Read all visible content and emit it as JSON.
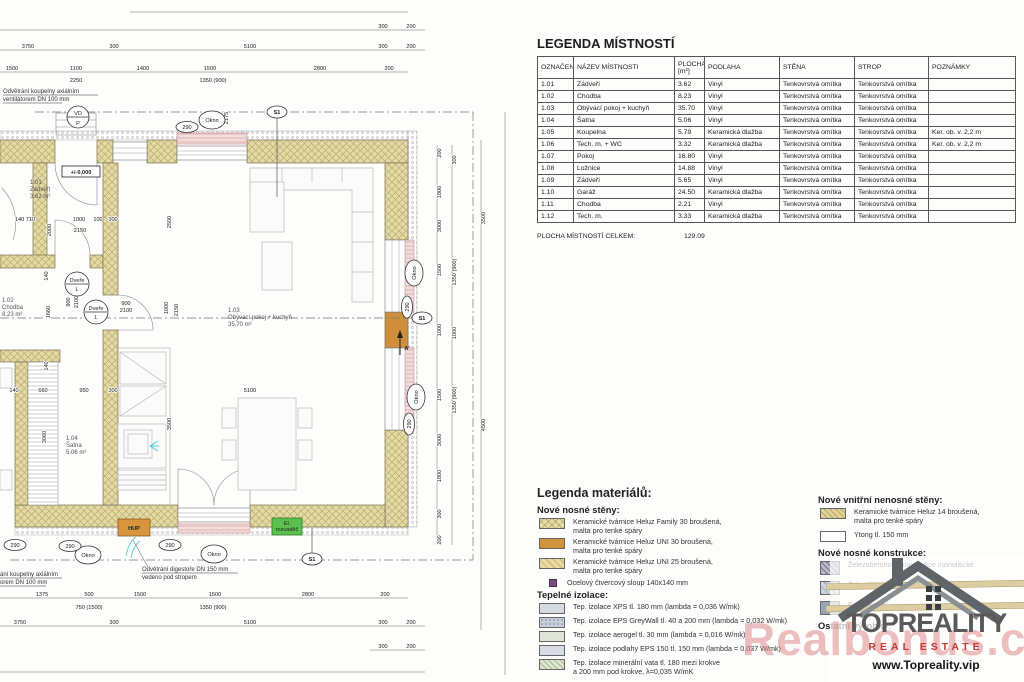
{
  "legend_table": {
    "title": "LEGENDA MÍSTNOSTÍ",
    "columns": [
      "OZNAČENÍ",
      "NÁZEV MÍSTNOSTI",
      "PLOCHA\n[m²]",
      "PODLAHA",
      "STĚNA",
      "STROP",
      "POZNÁMKY"
    ],
    "rows": [
      [
        "1.01",
        "Zádveří",
        "3.62",
        "Vinyl",
        "Tenkovrstvá omítka",
        "Tenkovrstvá omítka",
        ""
      ],
      [
        "1.02",
        "Chodba",
        "8.23",
        "Vinyl",
        "Tenkovrstvá omítka",
        "Tenkovrstvá omítka",
        ""
      ],
      [
        "1.03",
        "Obývací pokoj + kuchyň",
        "35.70",
        "Vinyl",
        "Tenkovrstvá omítka",
        "Tenkovrstvá omítka",
        ""
      ],
      [
        "1.04",
        "Šatna",
        "5.06",
        "Vinyl",
        "Tenkovrstvá omítka",
        "Tenkovrstvá omítka",
        ""
      ],
      [
        "1.05",
        "Koupelna",
        "5.79",
        "Keramická dlažba",
        "Tenkovrstvá omítka",
        "Tenkovrstvá omítka",
        "Ker. ob. v. 2,2 m"
      ],
      [
        "1.06",
        "Tech. m. + WC",
        "3.32",
        "Keramická dlažba",
        "Tenkovrstvá omítka",
        "Tenkovrstvá omítka",
        "Ker. ob. v. 2,2 m"
      ],
      [
        "1.07",
        "Pokoj",
        "16.80",
        "Vinyl",
        "Tenkovrstvá omítka",
        "Tenkovrstvá omítka",
        ""
      ],
      [
        "1.08",
        "Ložnice",
        "14.88",
        "Vinyl",
        "Tenkovrstvá omítka",
        "Tenkovrstvá omítka",
        ""
      ],
      [
        "1.09",
        "Zádveří",
        "5.65",
        "Vinyl",
        "Tenkovrstvá omítka",
        "Tenkovrstvá omítka",
        ""
      ],
      [
        "1.10",
        "Garáž",
        "24.50",
        "Keramická dlažba",
        "Tenkovrstvá omítka",
        "Tenkovrstvá omítka",
        ""
      ],
      [
        "1.11",
        "Chodba",
        "2.21",
        "Vinyl",
        "Tenkovrstvá omítka",
        "Tenkovrstvá omítka",
        ""
      ],
      [
        "1.12",
        "Tech. m.",
        "3.33",
        "Keramická dlažba",
        "Tenkovrstvá omítka",
        "Tenkovrstvá omítka",
        ""
      ]
    ],
    "total_label": "PLOCHA MÍSTNOSTÍ CELKEM:",
    "total_value": "129.09"
  },
  "materials": {
    "title": "Legenda materiálů:",
    "sections": [
      {
        "heading": "Nové nosné stěny:",
        "items": [
          {
            "swatch": "sw-family",
            "lines": [
              "Keramické tvárnice Heluz Family 30 broušená,",
              "malta pro tenké spáry"
            ]
          },
          {
            "swatch": "sw-uni30",
            "lines": [
              "Keramické tvárnice Heluz UNI 30 broušená,",
              "malta pro tenké spáry"
            ]
          },
          {
            "swatch": "sw-uni25",
            "lines": [
              "Keramické tvárnice Heluz UNI 25 broušená,",
              "malta pro tenké spáry"
            ]
          },
          {
            "swatch": "sw-steel",
            "lines": [
              "Ocelový čtvercový sloup 140x140 mm"
            ]
          }
        ]
      },
      {
        "heading": "Tepelné izolace:",
        "items": [
          {
            "swatch": "sw-xps",
            "lines": [
              "Tep. izolace XPS tl. 180 mm (lambda = 0,036 W/mk)"
            ]
          },
          {
            "swatch": "sw-eps",
            "lines": [
              "Tep. izolace EPS GreyWall tl. 40 a 200 mm (lambda = 0,032 W/mk)"
            ]
          },
          {
            "swatch": "sw-aerogel",
            "lines": [
              "Tep. izolace aerogel tl. 30 mm (lambda = 0,016 W/mk)"
            ]
          },
          {
            "swatch": "sw-floor",
            "lines": [
              "Tep. izolace podlahy EPS 150 tl. 150 mm (lambda = 0,037 W/mk)"
            ]
          },
          {
            "swatch": "sw-mineral",
            "lines": [
              "Tep. izolace minerální vata tl. 180 mezi krokve",
              "a 200 mm pod krokve, λ=0,035 W/mK"
            ]
          }
        ]
      },
      {
        "heading": "Nové vnitřní nenosné stěny:",
        "items": [
          {
            "swatch": "sw-heluz14",
            "lines": [
              "Keramické tvárnice Heluz 14 broušená,",
              "malta pro tenké spáry"
            ]
          },
          {
            "swatch": "sw-ytong",
            "lines": [
              "Ytong tl. 150 mm"
            ]
          }
        ]
      },
      {
        "heading": "Nové nosné konstrukce:",
        "items": [
          {
            "swatch": "sw-zbmono",
            "lines": [
              "Železobetonové konstrukce monolitické"
            ]
          },
          {
            "swatch": "sw-zbprefa",
            "lines": [
              "Železobetonové konstrukce prefa-monolitické"
            ]
          },
          {
            "swatch": "sw-beton",
            "lines": [
              "Beton prostý"
            ]
          }
        ]
      },
      {
        "heading": "Ostatní výrobky:",
        "items": []
      }
    ]
  },
  "plan": {
    "rooms": [
      {
        "id": "1.01",
        "name": "Zádveří",
        "area": "3.62 m²"
      },
      {
        "id": "1.02",
        "name": "Chodba",
        "area": "8.23 m²"
      },
      {
        "id": "1.03",
        "name": "Obývací pokoj + kuchyň",
        "area": "35.70 m²"
      },
      {
        "id": "1.04",
        "name": "Šatna",
        "area": "5.06 m²"
      }
    ],
    "elevation": "+/-0,000",
    "notes": {
      "vent_top": [
        "Odvětrání koupelny axiálním",
        "ventilátorem DN 100 mm"
      ],
      "vent_bottom": [
        "ání koupelny axiálním",
        "orem DN 100 mm"
      ],
      "hood": [
        "Odvětrání digestoře DN 150 mm",
        "vedeno pod stropem"
      ]
    },
    "markers": {
      "okno": "Okno",
      "s1": "S1",
      "n290": "290",
      "vd": "VD",
      "p": "P",
      "dvere": "Dveře",
      "l": "L",
      "a_prime": "A'"
    },
    "boxes": {
      "hup": "HUP",
      "el1": "El.",
      "el2": "rozvaděč"
    },
    "dims": {
      "top1": [
        "300",
        "200"
      ],
      "top2": [
        "3750",
        "300",
        "5100",
        "300",
        "200"
      ],
      "top3": [
        "1500",
        "1100",
        "1400",
        "1500",
        "2800",
        "200"
      ],
      "top3sub": [
        "2250",
        "1350 (900)"
      ],
      "bottom1": [
        "1375",
        "500",
        "1500",
        "1500",
        "2800",
        "200"
      ],
      "bottom1sub": [
        "750 (1500)",
        "1350 (900)"
      ],
      "bottom2": [
        "3750",
        "300",
        "5100",
        "300",
        "200"
      ],
      "bottom3": [
        "300",
        "200"
      ],
      "right1": [
        "200",
        "1800",
        "3000",
        "1500",
        "1000",
        "1500",
        "3000",
        "1800",
        "300",
        "200"
      ],
      "right2": [
        "300",
        "1350 (900)",
        "1000",
        "1350 (900)"
      ],
      "right3": [
        "3500",
        "4500"
      ],
      "interior": [
        "950",
        "2175",
        "2000",
        "140 710",
        "1000",
        "100",
        "300",
        "2150",
        "900",
        "2100",
        "2500",
        "1000",
        "2150",
        "900",
        "2100",
        "1660",
        "140",
        "140",
        "140",
        "660",
        "950",
        "300",
        "3060",
        "3500",
        "5100"
      ]
    }
  },
  "watermark": {
    "brand": "TOPREALITY",
    "tagline": "REAL ESTATE",
    "url": "www.Topreality.vip",
    "faint": "Realbonus.cz",
    "accent_red": "#c23b3b",
    "brand_gray": "#595959"
  }
}
